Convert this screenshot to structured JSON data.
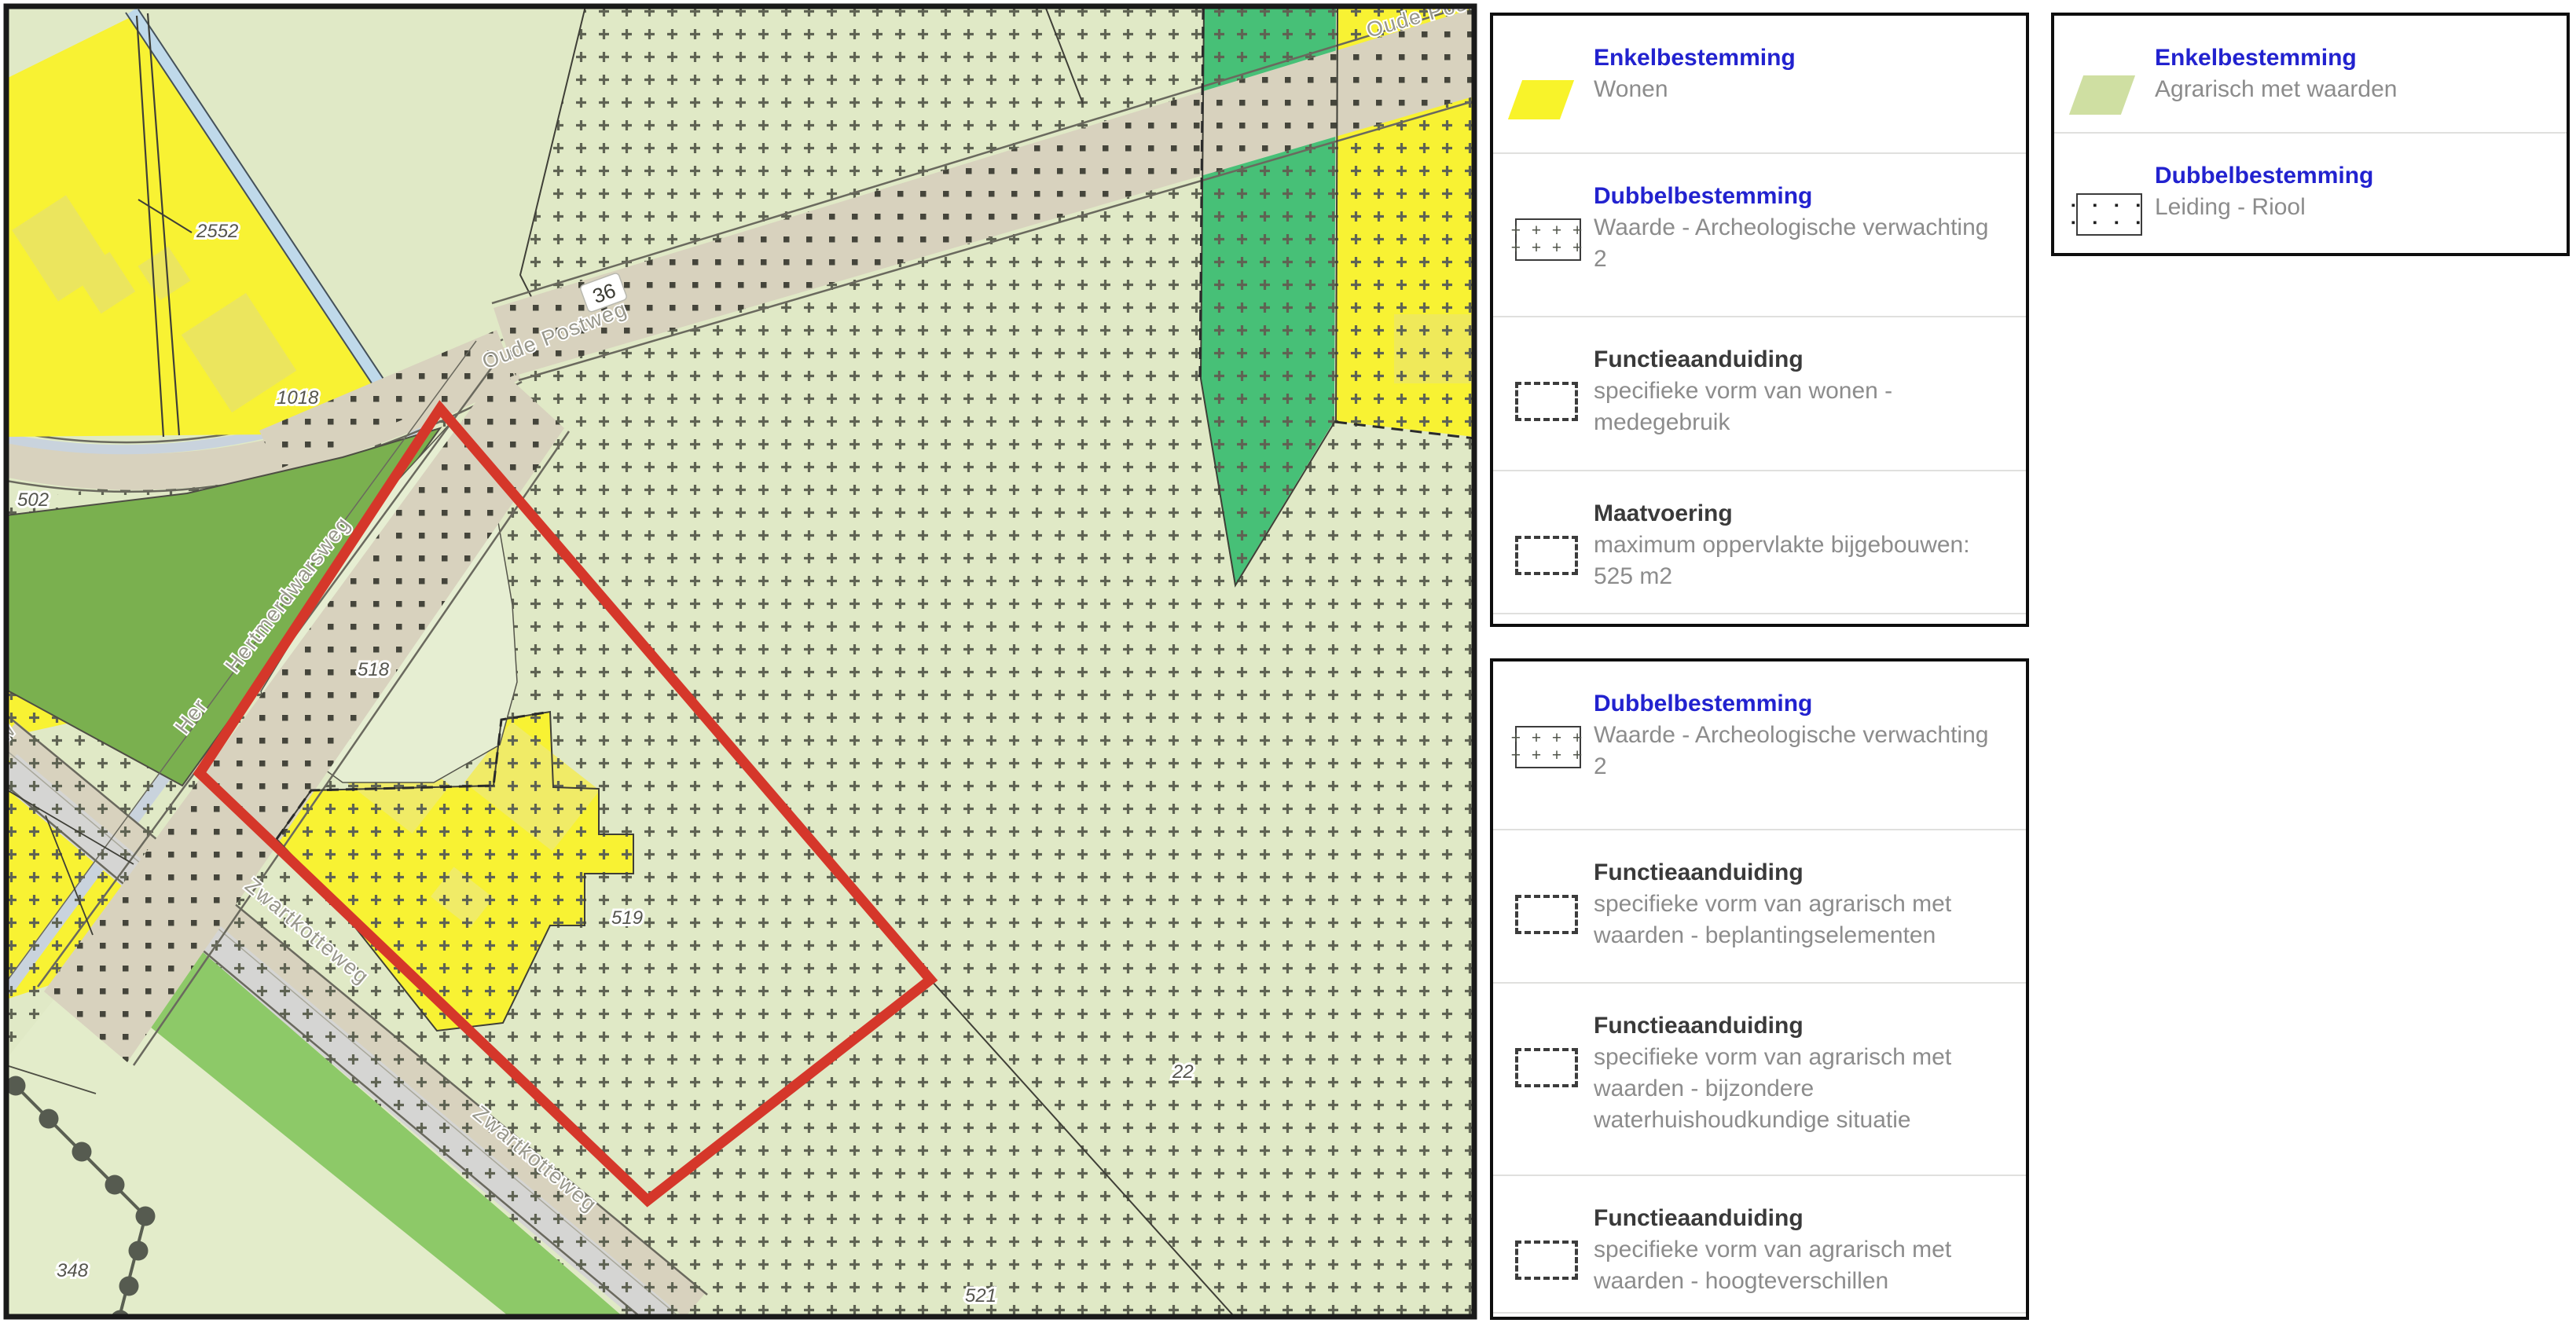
{
  "map": {
    "parcels": {
      "p2552": "2552",
      "p1018": "1018",
      "p502": "502",
      "p518": "518",
      "p519": "519",
      "p521": "521",
      "p348": "348",
      "p22": "22",
      "house_number": "36"
    },
    "streets": {
      "oude_postweg": "Oude Postweg",
      "oude_postweg_2": "Oude Postweg",
      "hertmerdwarsweg": "Hertmerdwarsweg",
      "hertmer_fragment": "Her",
      "zwartkotteweg": "Zwartkotteweg",
      "zwartkotteweg_2": "Zwartkotteweg",
      "edge_fragment": "w"
    },
    "colors": {
      "plan_boundary_red": "#d5372a",
      "wonen_yellow": "#f8f233",
      "agrarisch_pale_green": "#e0e9c6",
      "dark_green_parcel": "#7ab04f",
      "teal_parcel": "#47c077",
      "green_strip": "#8dc968",
      "road_beige": "#d8d2be",
      "road_gray": "#d5d5d3",
      "water_blue": "#bfd9ea",
      "cross_pattern": "#5f6353",
      "dot_pattern": "#45453b"
    }
  },
  "legend_panel_1": {
    "items": [
      {
        "category": "Enkelbestemming",
        "label": "Wonen",
        "swatch": "yellow-parallelogram"
      },
      {
        "category": "Dubbelbestemming",
        "label": "Waarde - Archeologische verwachting 2",
        "swatch": "cross-rect"
      },
      {
        "category": "Functieaanduiding",
        "label": "specifieke vorm van wonen - medegebruik",
        "swatch": "dashed-rect"
      },
      {
        "category": "Maatvoering",
        "label": "maximum oppervlakte bijgebouwen: 525 m2",
        "swatch": "dashed-rect"
      }
    ]
  },
  "legend_panel_2": {
    "items": [
      {
        "category": "Dubbelbestemming",
        "label": "Waarde - Archeologische verwachting 2",
        "swatch": "cross-rect"
      },
      {
        "category": "Functieaanduiding",
        "label": "specifieke vorm van agrarisch met waarden - beplantingselementen",
        "swatch": "dashed-rect"
      },
      {
        "category": "Functieaanduiding",
        "label": "specifieke vorm van agrarisch met waarden - bijzondere waterhuishoudkundige situatie",
        "swatch": "dashed-rect"
      },
      {
        "category": "Functieaanduiding",
        "label": "specifieke vorm van agrarisch met waarden - hoogteverschillen",
        "swatch": "dashed-rect"
      }
    ]
  },
  "legend_panel_3": {
    "items": [
      {
        "category": "Enkelbestemming",
        "label": "Agrarisch met waarden",
        "swatch": "green-parallelogram"
      },
      {
        "category": "Dubbelbestemming",
        "label": "Leiding - Riool",
        "swatch": "dot-rect"
      }
    ]
  },
  "swatch_glyphs": {
    "cross_row": "+ + + +",
    "dot_row": "▪ ▪ ▪ ▪"
  }
}
